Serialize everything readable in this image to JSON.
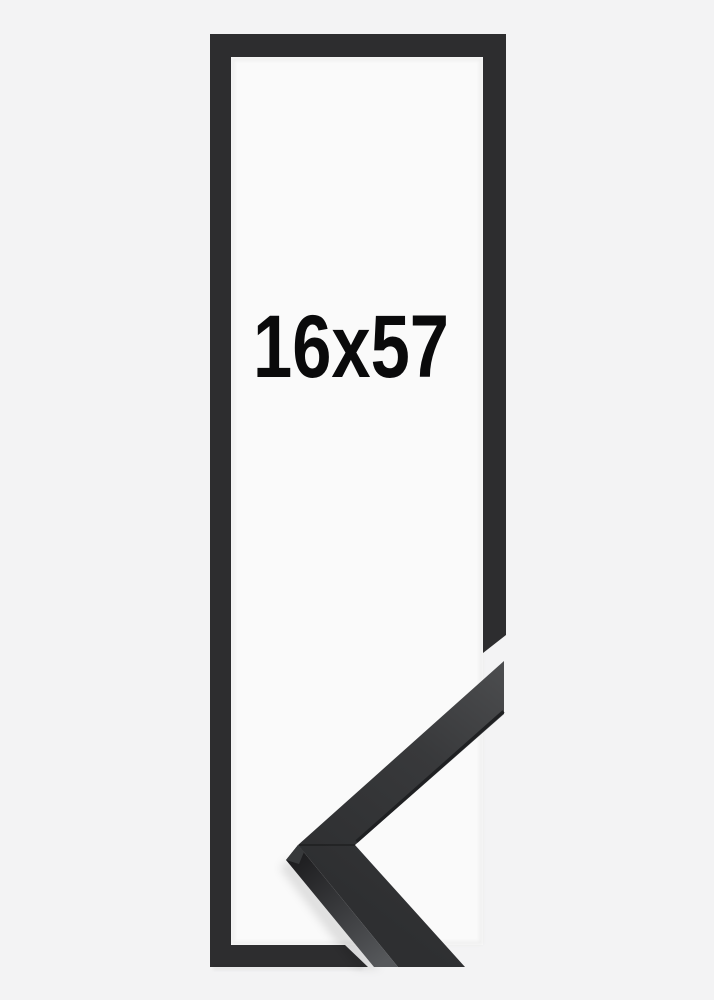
{
  "product_image": {
    "size_label": "16x57",
    "colors": {
      "background": "#f3f3f4",
      "opening": "#fafafa",
      "frame": "#2d2d2f",
      "label_text": "#0a0a0b",
      "sample_face_light": "#4d4e50",
      "sample_face_mid": "#38393b",
      "sample_face_dark": "#2e2f31",
      "sample_side_dark": "#1c1c1e",
      "sample_side_light": "#56585b",
      "sample_facet": "#37393b",
      "sample_lip": "#1f2022"
    }
  }
}
